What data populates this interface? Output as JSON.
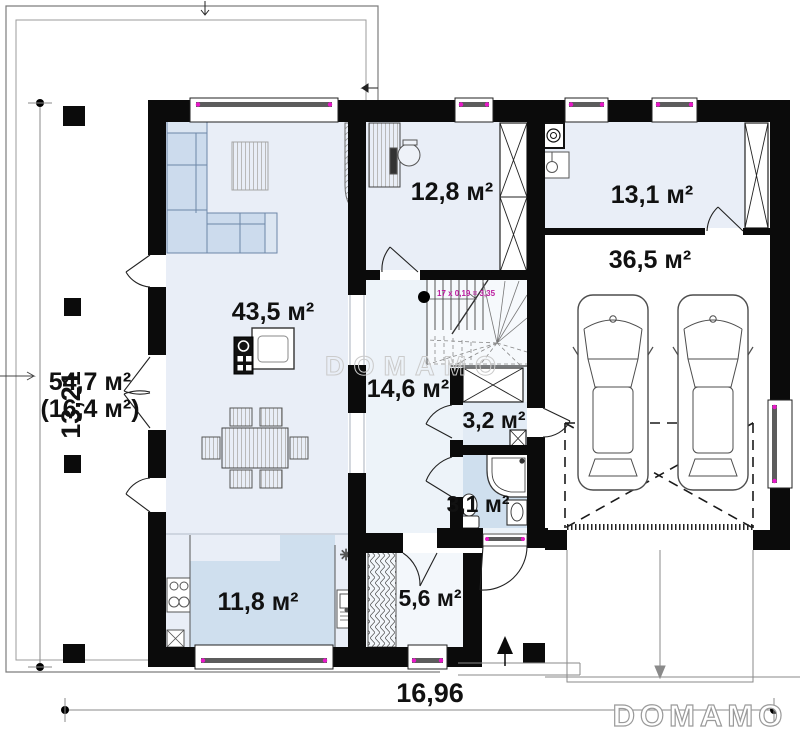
{
  "plan": {
    "rooms": {
      "living": "43,5 м²",
      "office": "12,8 м²",
      "utility": "13,1 м²",
      "garage": "36,5 м²",
      "hall": "14,6 м²",
      "entry": "3,2 м²",
      "bathroom": "3,1 м²",
      "kitchen": "11,8 м²",
      "vestibule": "5,6 м²",
      "terrace_line1": "54,7 м²",
      "terrace_line2": "(16,4 м²)"
    },
    "dimensions": {
      "overall_width": "16,96",
      "overall_height": "13,21"
    },
    "stairs": {
      "note": "17 x 0,19 = 3,35"
    },
    "watermark_center": "DOMAMO",
    "brand": "DOMAMO",
    "colors": {
      "wall": "#0b0b0b",
      "floor_light": "#e9eef7",
      "floor_blue": "#cfdfee",
      "furniture_blue": "#ccdbed",
      "accent_magenta": "#e818c8",
      "dim_line": "#8a8a8a",
      "watermark": "#cbcbcb"
    }
  }
}
